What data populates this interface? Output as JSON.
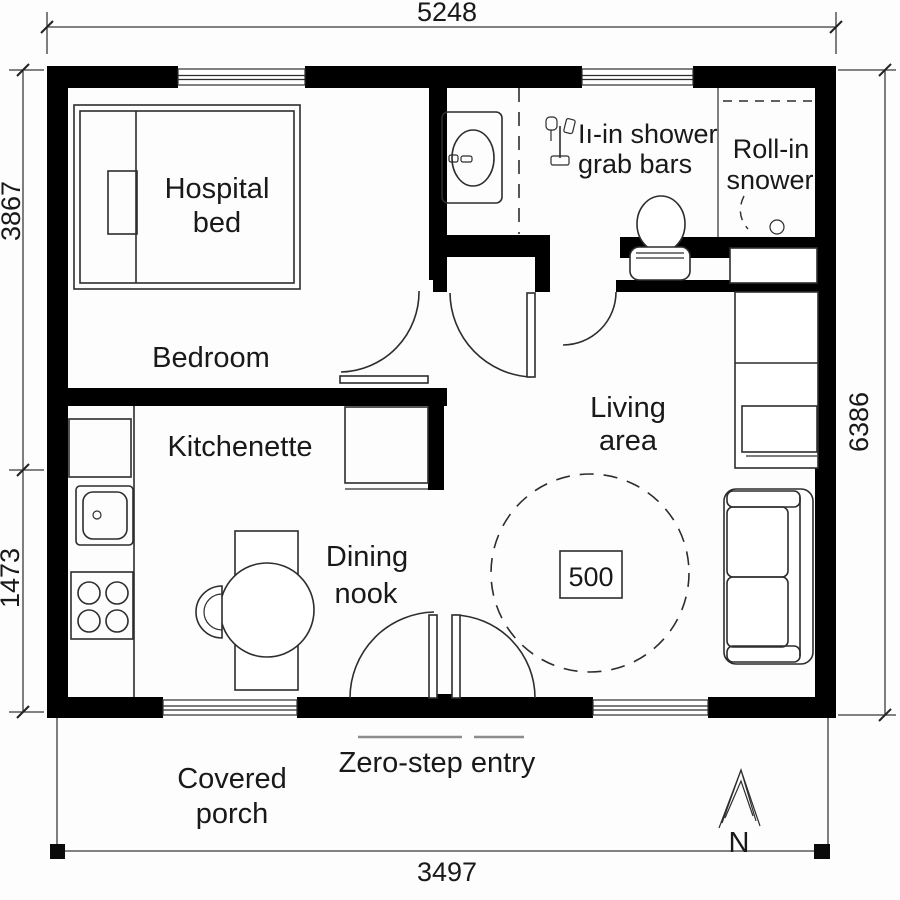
{
  "dims": {
    "width_top": "5248",
    "height_left_upper": "3867",
    "height_left_lower": "1473",
    "height_right": "6386",
    "porch_width": "3497"
  },
  "labels": {
    "hospital_bed": {
      "line1": "Hospital",
      "line2": "bed"
    },
    "bedroom": "Bedroom",
    "kitchenette": "Kitchenette",
    "dining_nook": {
      "line1": "Dining",
      "line2": "nook"
    },
    "living_area": {
      "line1": "Living",
      "line2": "area"
    },
    "roll_in_shower": {
      "line1": "Roll-in",
      "line2": "snower"
    },
    "grab_bars": {
      "line1": "Iı-in shower",
      "line2": "grab bars"
    },
    "covered_porch": {
      "line1": "Covered",
      "line2": "porch"
    },
    "zero_step_entry": "Zero-step entry"
  },
  "annotations": {
    "turning_circle_diameter": "500",
    "north": "N"
  },
  "colors": {
    "wall": "#000000",
    "line": "#2d2d2d",
    "text": "#191919",
    "background": "#fdfdfd"
  }
}
